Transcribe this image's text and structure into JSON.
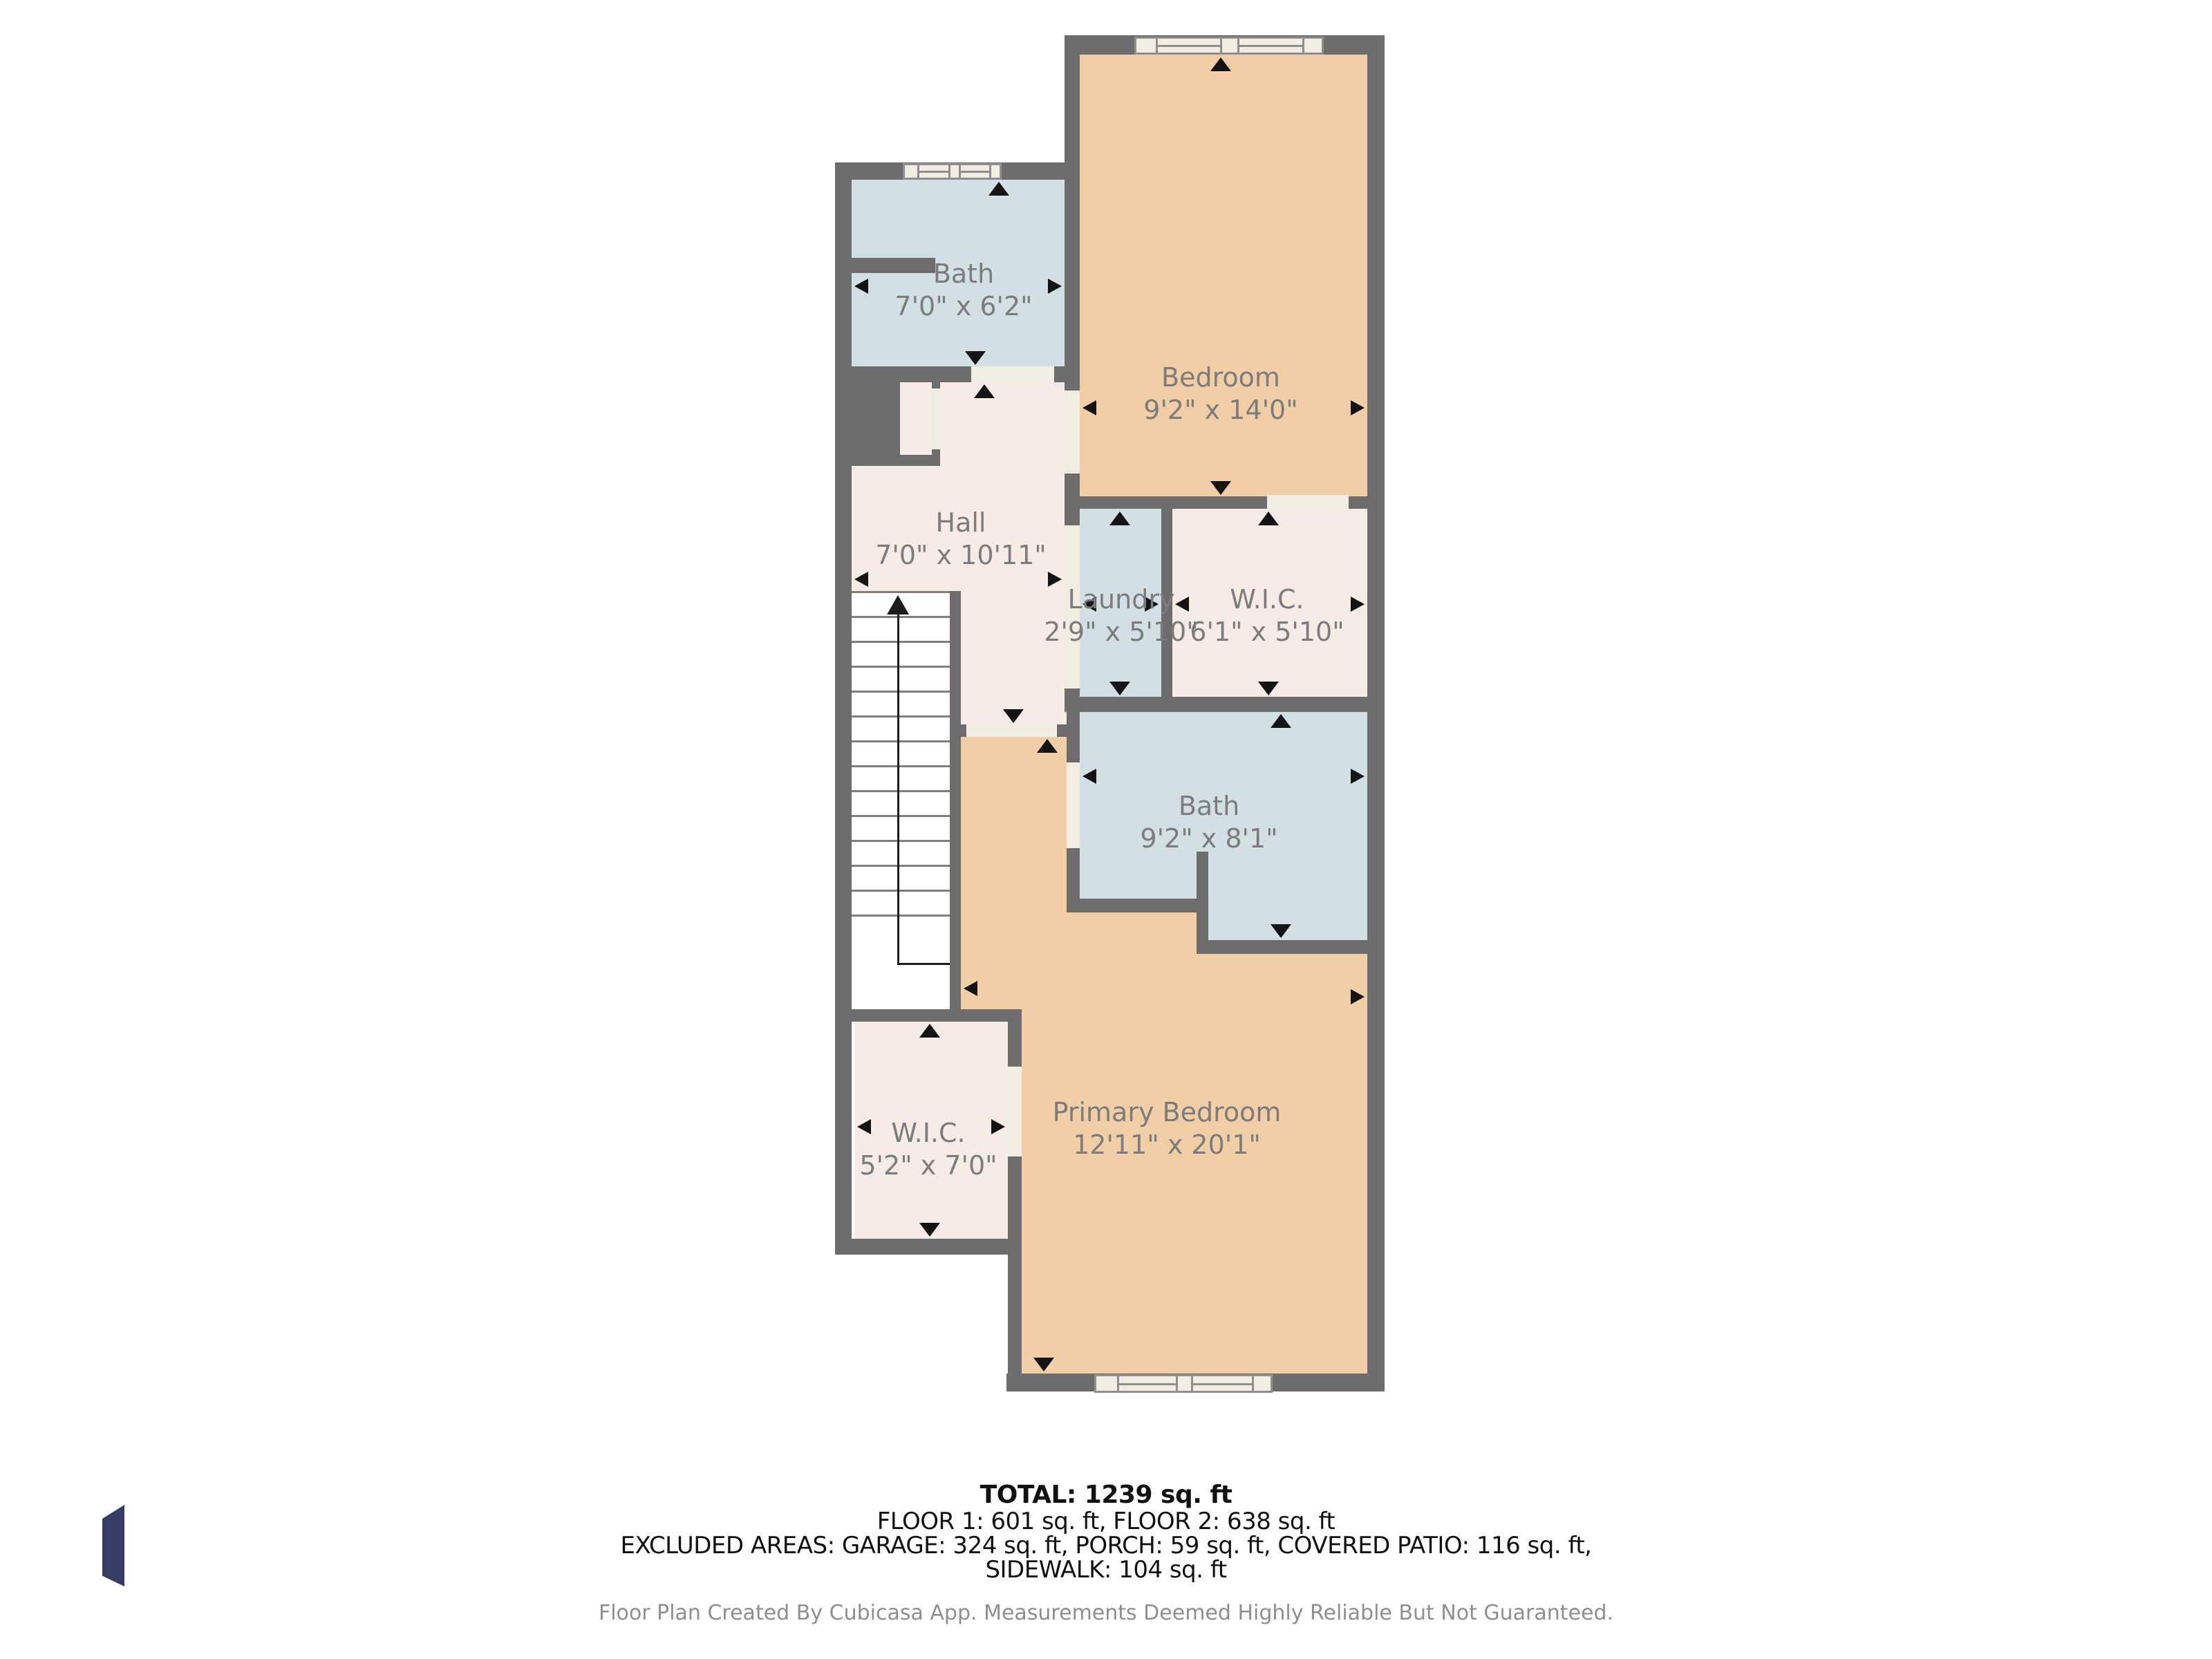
{
  "rooms": {
    "bath_upper": {
      "name": "Bath",
      "dims": "7'0\" x 6'2\""
    },
    "bedroom": {
      "name": "Bedroom",
      "dims": "9'2\" x 14'0\""
    },
    "hall": {
      "name": "Hall",
      "dims": "7'0\" x 10'11\""
    },
    "laundry": {
      "name": "Laundry",
      "dims": "2'9\" x 5'10\""
    },
    "wic_upper": {
      "name": "W.I.C.",
      "dims": "6'1\" x 5'10\""
    },
    "bath_lower": {
      "name": "Bath",
      "dims": "9'2\" x 8'1\""
    },
    "wic_lower": {
      "name": "W.I.C.",
      "dims": "5'2\" x 7'0\""
    },
    "primary_bedroom": {
      "name": "Primary Bedroom",
      "dims": "12'11\" x 20'1\""
    }
  },
  "summary": {
    "total": "TOTAL: 1239 sq. ft",
    "floors": "FLOOR 1: 601 sq. ft, FLOOR 2: 638 sq. ft",
    "excluded": "EXCLUDED AREAS: GARAGE: 324 sq. ft, PORCH: 59 sq. ft, COVERED PATIO: 116 sq. ft,",
    "excluded2": "SIDEWALK: 104 sq. ft"
  },
  "disclaimer": "Floor Plan Created By Cubicasa App. Measurements Deemed Highly Reliable But Not Guaranteed.",
  "colors": {
    "wall": "#6d6d6d",
    "room_warm": "#f1cea6",
    "room_blue": "#d2e0e3",
    "room_cream": "#f6ebe5",
    "door_sill": "#f2ede3",
    "label_text": "#7c7c7c",
    "logo_navy": "#363c63"
  }
}
